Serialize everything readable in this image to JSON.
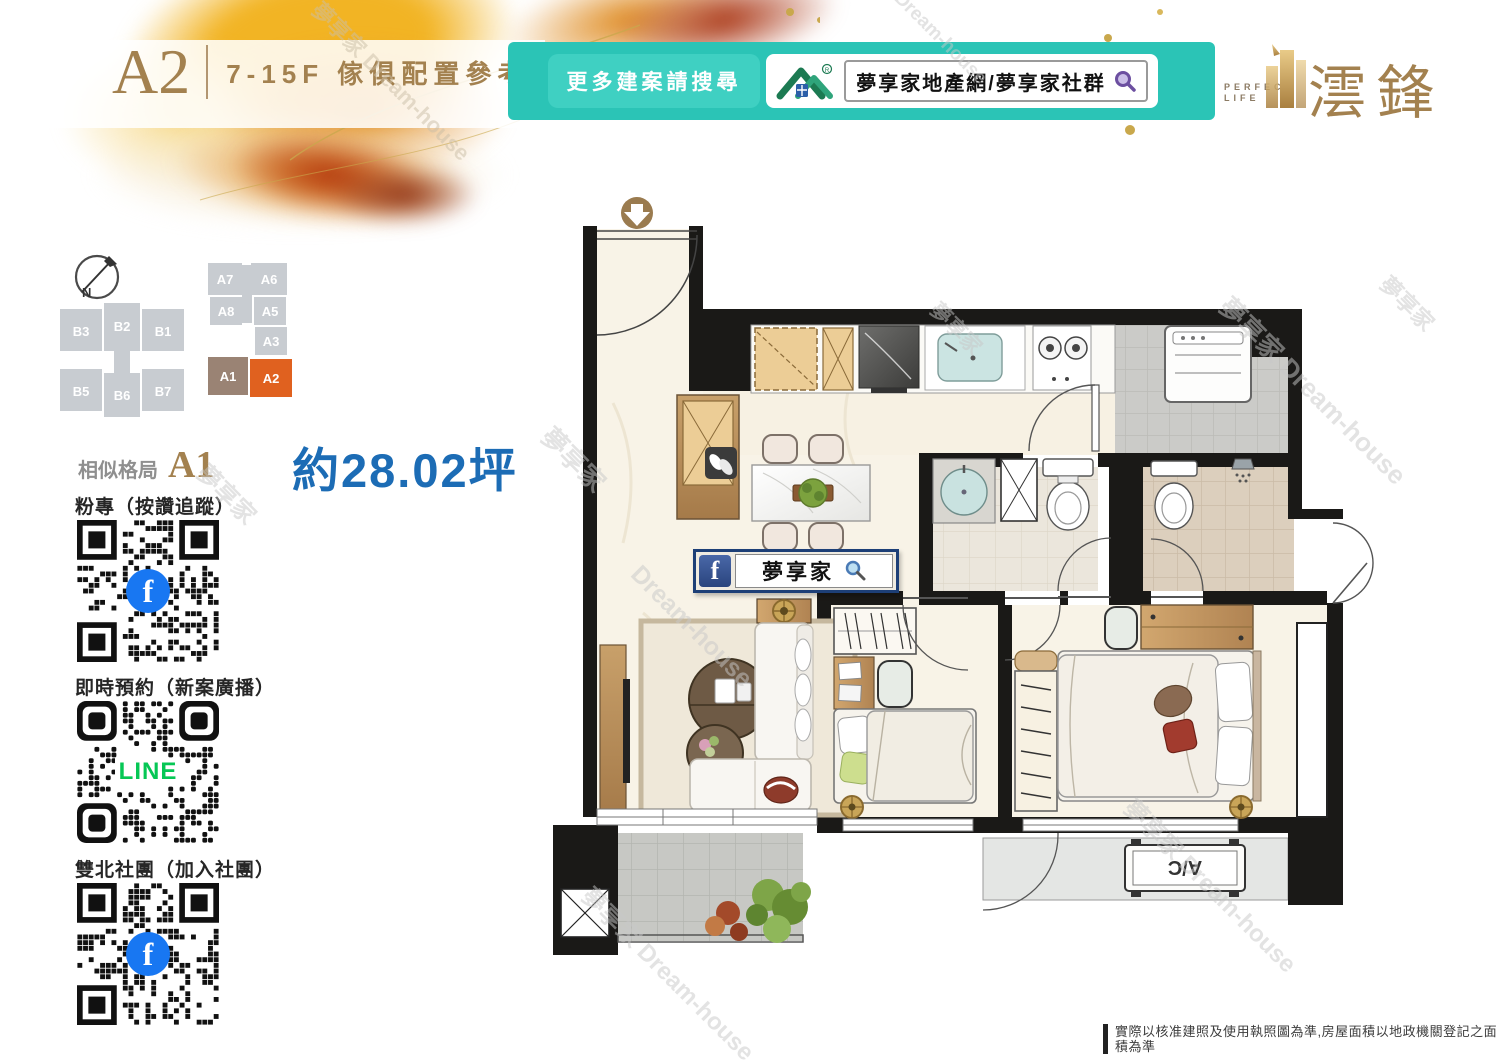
{
  "header": {
    "unit": "A2",
    "subtitle": "7-15F 傢俱配置參考圖"
  },
  "banner": {
    "label": "更多建案請搜尋",
    "search_text": "夢享家地產網/夢享家社群"
  },
  "brand": {
    "tagline_top": "PERFECT",
    "tagline_bottom": "LIFE",
    "name": "澐鋒"
  },
  "keyplan": {
    "north": "N",
    "b_units": [
      "B3",
      "B2",
      "B1",
      "B5",
      "B6",
      "B7"
    ],
    "a_units": [
      "A7",
      "A6",
      "A8",
      "A5",
      "A3",
      "A1",
      "A2"
    ],
    "highlighted_unit": "A2",
    "similar_unit": "A1"
  },
  "info": {
    "similar_label": "相似格局",
    "similar_unit": "A1",
    "area": "約28.02坪"
  },
  "qr_sections": [
    {
      "label": "粉專（按讚追蹤）",
      "badge": "f",
      "type": "facebook"
    },
    {
      "label": "即時預約（新案廣播）",
      "badge": "LINE",
      "type": "line"
    },
    {
      "label": "雙北社團（加入社團）",
      "badge": "f",
      "type": "facebook"
    }
  ],
  "floorplan": {
    "fb_icon": "f",
    "fb_text": "夢享家",
    "ac_label": "A/C"
  },
  "watermark": {
    "cn": "夢享家",
    "en": "Dream-house",
    "combo": "夢享家 Dream-house"
  },
  "disclaimer": "實際以核准建照及使用執照圖為準,房屋面積以地政機關登記之面積為準",
  "colors": {
    "teal": "#2BC4B6",
    "gold": "#A3814F",
    "area_blue": "#1C6CB5",
    "a2_orange": "#E0611F",
    "a1_taupe": "#9A8374",
    "facebook_blue": "#1877F2",
    "line_green": "#06C755"
  }
}
